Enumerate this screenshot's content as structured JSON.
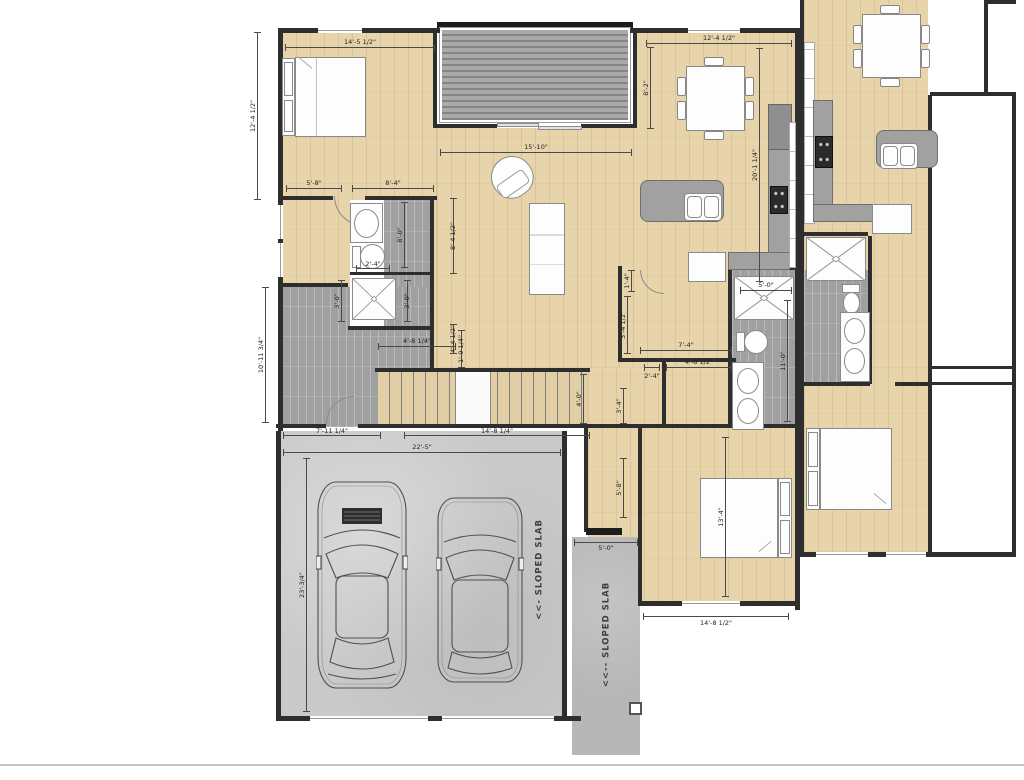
{
  "texts": {
    "slab_garage": "<<- SLOPED SLAB",
    "slab_walkway": "<<-- SLOPED SLAB"
  },
  "dims": {
    "bed1_w": "14'-5 1/2\"",
    "bed1_h": "12'-4 1/2\"",
    "living_w": "15'-10\"",
    "dining_w": "12'-4 1/2\"",
    "dining_h": "8'-2\"",
    "kitchen_run": "20'-1 1/4\"",
    "bath_hall_l": "5'-8\"",
    "bath_hall_r": "8'-4\"",
    "bath_len": "8'-0\"",
    "toilet_w": "2'-4\"",
    "bath_side_u": "8'-4 1/2\"",
    "bath_side_l": "4'-4 1/2\"",
    "shower_w_l": "3'-0\"",
    "shower_w_r": "3'-0\"",
    "mud_h": "10'-11 3/4\"",
    "mud_w": "7'-11 1/4\"",
    "stair_top": "4'-8 1/4\"",
    "stair_nose": "1'-9 1/4\"",
    "stair_w": "14'-8 1/4\"",
    "stair_h": "4'-0\"",
    "garage_w": "22'-5\"",
    "garage_h": "23'-3/4\"",
    "hall_a": "1'-4\"",
    "hall_b": "3'-4 1/2\"",
    "hall_c": "7'-4\"",
    "closet_a": "2'-4\"",
    "closet_b": "4'-8 1/2\"",
    "hall_d": "3'-4\"",
    "hall_e": "5'-8\"",
    "mshower_w": "5'-0\"",
    "mbath_len": "11'-0\"",
    "bed2_h": "13'-4\"",
    "bed2_w": "14'-8 1/2\"",
    "slab_w": "5'-0\""
  }
}
